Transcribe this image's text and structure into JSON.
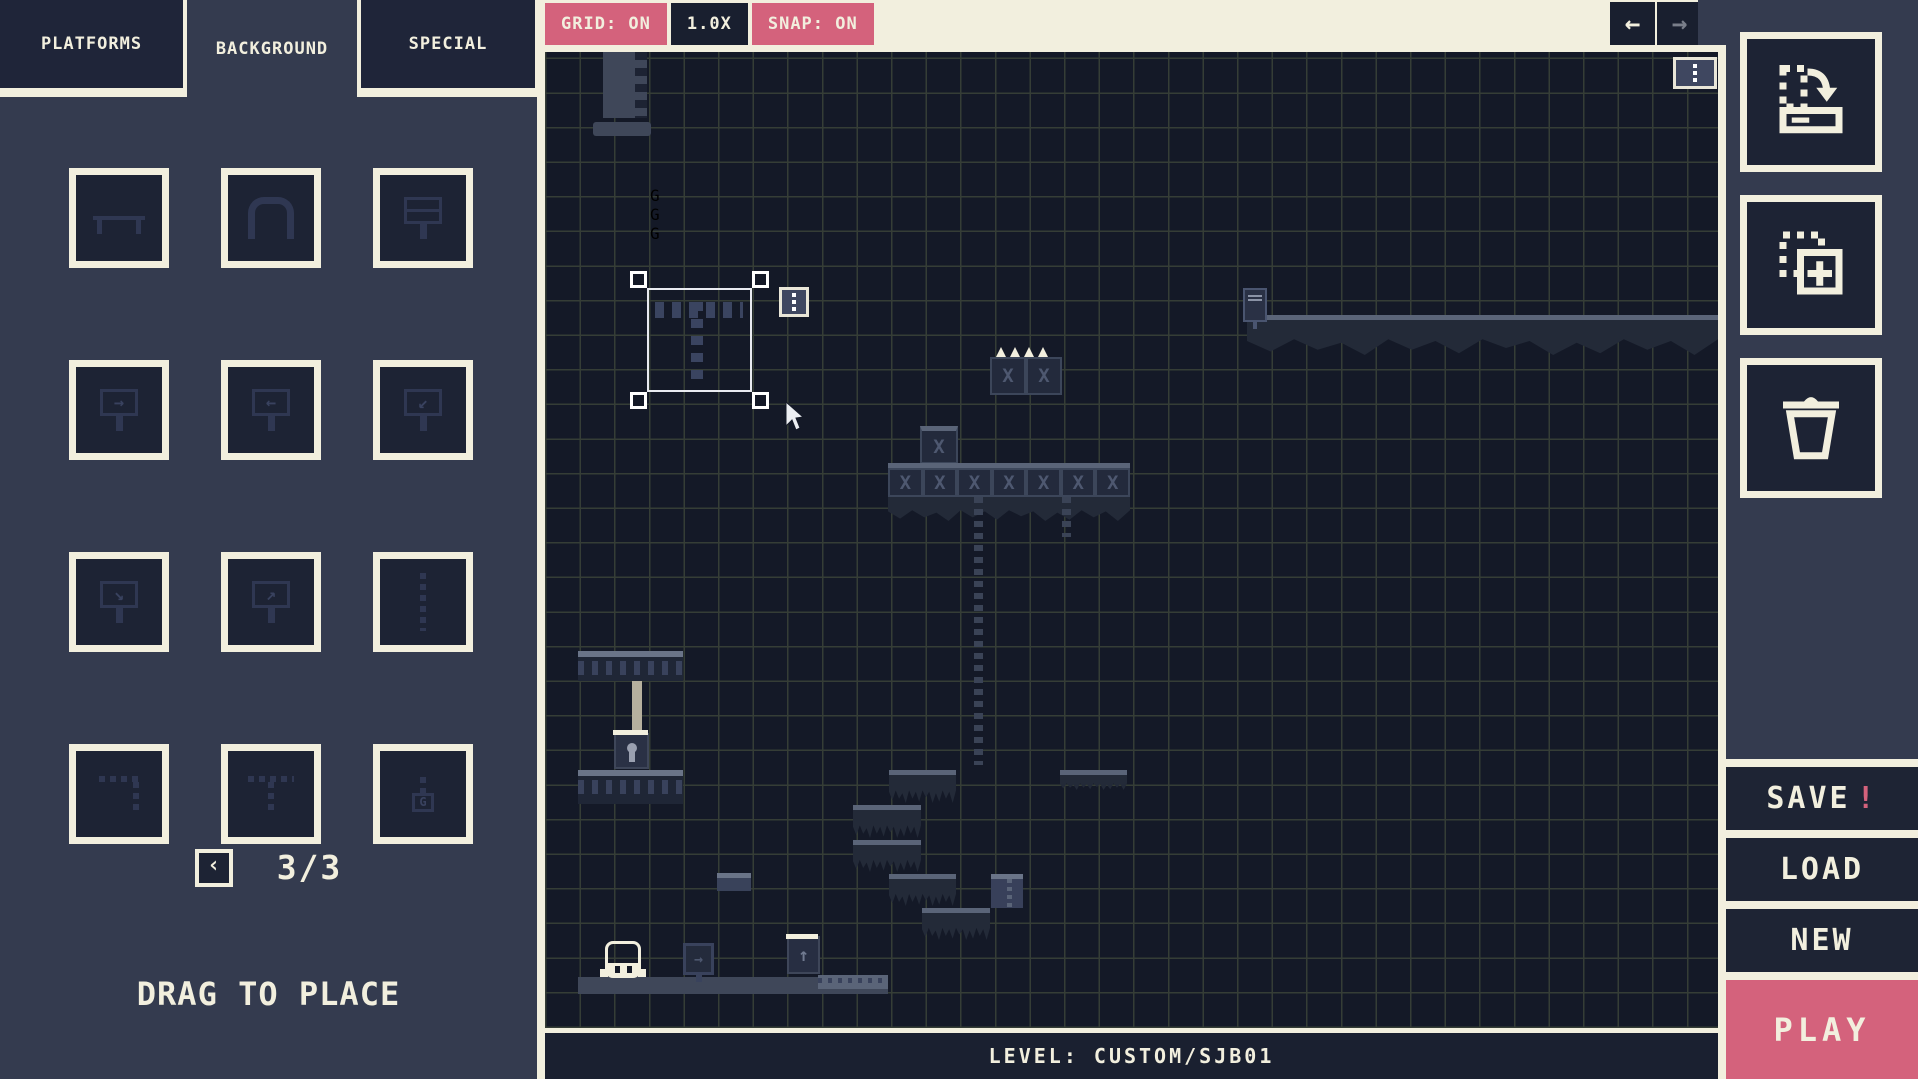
{
  "colors": {
    "pink": "#d4627c",
    "cream": "#f2efde",
    "navy": "#343b4f",
    "panel_dark": "#1d2334",
    "canvas_bg": "#141927",
    "grid_line": "#353d36"
  },
  "palette": {
    "tabs": [
      {
        "label": "PLATFORMS",
        "active": false
      },
      {
        "label": "BACKGROUND",
        "active": true
      },
      {
        "label": "SPECIAL",
        "active": false
      }
    ],
    "tiles": [
      {
        "name": "rail-platform",
        "kind": "bench"
      },
      {
        "name": "arch",
        "kind": "arch"
      },
      {
        "name": "billboard-text",
        "kind": "sign-text"
      },
      {
        "name": "sign-arrow-right",
        "kind": "sign",
        "glyph": "→"
      },
      {
        "name": "sign-arrow-left",
        "kind": "sign",
        "glyph": "←"
      },
      {
        "name": "sign-arrow-down-left",
        "kind": "sign",
        "glyph": "↙"
      },
      {
        "name": "sign-arrow-down-right",
        "kind": "sign",
        "glyph": "↘"
      },
      {
        "name": "sign-arrow-up-right",
        "kind": "sign",
        "glyph": "↗"
      },
      {
        "name": "chain-vertical",
        "kind": "chain-v"
      },
      {
        "name": "chain-corner",
        "kind": "chain-corner"
      },
      {
        "name": "chain-t",
        "kind": "chain-t"
      },
      {
        "name": "chain-lantern",
        "kind": "chain-lantern",
        "glyph": "G"
      }
    ],
    "pagination": {
      "prev_label": "‹",
      "label": "3/3",
      "current": 3,
      "total": 3
    },
    "hint": "DRAG TO PLACE"
  },
  "toolbar": {
    "grid_label": "GRID: ON",
    "zoom_label": "1.0X",
    "snap_label": "SNAP: ON",
    "undo_glyph": "←",
    "redo_glyph": "→"
  },
  "actions": {
    "save_label": "SAVE",
    "save_alert": "!",
    "load_label": "LOAD",
    "new_label": "NEW",
    "play_label": "PLAY"
  },
  "statusbar": {
    "level_label": "LEVEL: CUSTOM/SJB01"
  },
  "canvas": {
    "crate_glyph": "X",
    "chip_glyph": "G",
    "items": [
      {
        "type": "tower",
        "x": 58,
        "y": 0,
        "w": 44,
        "h": 66
      },
      {
        "type": "bar",
        "x": 48,
        "y": 70,
        "w": 58,
        "h": 14
      },
      {
        "type": "dotted-platform",
        "x": 105,
        "y": 134,
        "w": 203,
        "h": 36
      },
      {
        "type": "long-ground",
        "x": 702,
        "y": 263,
        "w": 471,
        "h": 40
      },
      {
        "type": "sign-small",
        "x": 698,
        "y": 236,
        "w": 24,
        "h": 34
      },
      {
        "type": "spike-platform",
        "x": 445,
        "y": 305,
        "w": 72,
        "h": 38
      },
      {
        "type": "crate",
        "x": 375,
        "y": 374,
        "w": 38,
        "h": 38
      },
      {
        "type": "crate-row",
        "x": 343,
        "y": 411,
        "w": 242,
        "h": 34,
        "cells": 7
      },
      {
        "type": "moss",
        "x": 343,
        "y": 445,
        "w": 242,
        "h": 24
      },
      {
        "type": "chain-v",
        "x": 429,
        "y": 445,
        "w": 9,
        "h": 268
      },
      {
        "type": "chain-v",
        "x": 517,
        "y": 445,
        "w": 9,
        "h": 40
      },
      {
        "type": "step",
        "x": 344,
        "y": 718,
        "w": 67,
        "h": 33
      },
      {
        "type": "step",
        "x": 308,
        "y": 753,
        "w": 68,
        "h": 33
      },
      {
        "type": "step",
        "x": 308,
        "y": 788,
        "w": 68,
        "h": 32
      },
      {
        "type": "step",
        "x": 344,
        "y": 822,
        "w": 67,
        "h": 32
      },
      {
        "type": "step",
        "x": 377,
        "y": 856,
        "w": 68,
        "h": 32
      },
      {
        "type": "step",
        "x": 515,
        "y": 718,
        "w": 67,
        "h": 20
      },
      {
        "type": "zipper",
        "x": 446,
        "y": 822,
        "w": 32,
        "h": 34
      },
      {
        "type": "mini-platform",
        "x": 172,
        "y": 821,
        "w": 34,
        "h": 18
      },
      {
        "type": "piston-platform",
        "x": 33,
        "y": 599,
        "w": 105,
        "h": 30
      },
      {
        "type": "pole",
        "x": 87,
        "y": 629,
        "w": 10,
        "h": 52
      },
      {
        "type": "keybox",
        "x": 69,
        "y": 681,
        "w": 35,
        "h": 36
      },
      {
        "type": "piston-platform",
        "x": 33,
        "y": 718,
        "w": 105,
        "h": 34
      },
      {
        "type": "ground",
        "x": 33,
        "y": 925,
        "w": 310,
        "h": 17
      },
      {
        "type": "ground-light",
        "x": 273,
        "y": 923,
        "w": 70,
        "h": 14
      },
      {
        "type": "player",
        "x": 60,
        "y": 889,
        "w": 36,
        "h": 37
      },
      {
        "type": "sign",
        "x": 138,
        "y": 891,
        "w": 31,
        "h": 32,
        "glyph": "→"
      },
      {
        "type": "launcher",
        "x": 242,
        "y": 884,
        "w": 33,
        "h": 38,
        "glyph": "↑"
      },
      {
        "type": "kebab",
        "x": 1128,
        "y": 5,
        "w": 44,
        "h": 32,
        "name": "canvas-menu-button"
      },
      {
        "type": "selection",
        "x": 102,
        "y": 236,
        "w": 105,
        "h": 104
      },
      {
        "type": "kebab",
        "x": 234,
        "y": 235,
        "w": 30,
        "h": 30,
        "name": "selection-menu-button"
      },
      {
        "type": "cursor",
        "x": 240,
        "y": 350,
        "w": 22,
        "h": 30
      }
    ]
  }
}
